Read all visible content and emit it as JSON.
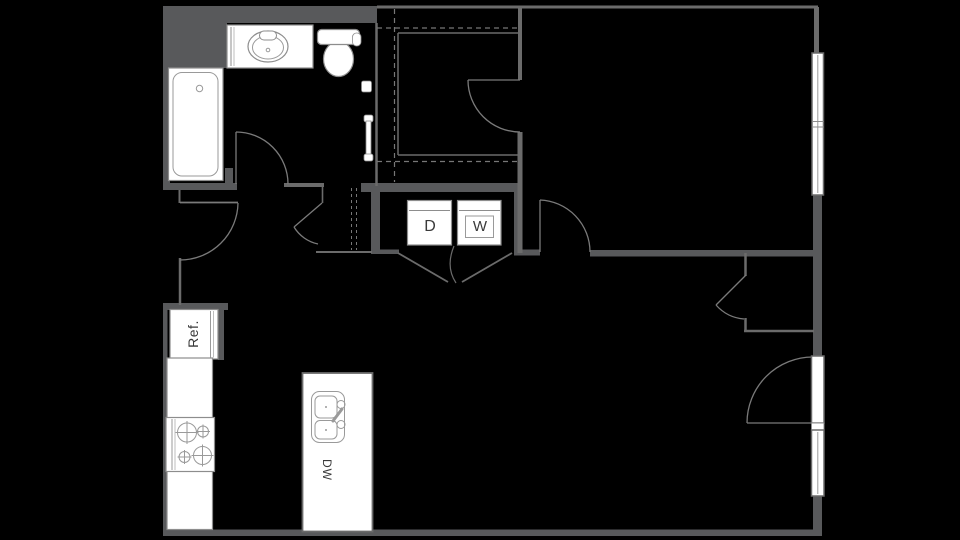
{
  "plan": {
    "type": "apartment-floor-plan",
    "labels": {
      "dryer": "D",
      "washer": "W",
      "refrigerator": "Ref.",
      "dishwasher": "DW"
    },
    "fixtures": [
      "bathtub",
      "vanity-sink",
      "toilet",
      "towel-bar",
      "toilet-paper-holder",
      "walk-in-closet-rod",
      "dryer",
      "washer",
      "bifold-doors",
      "refrigerator",
      "range-burners",
      "kitchen-counter",
      "island-sink",
      "dishwasher",
      "double-hung-window",
      "patio-door",
      "door-swing-arcs"
    ],
    "colors": {
      "background": "#000000",
      "wall_thick": "#58595b",
      "wall_thin": "#6b6b6b",
      "fixture_stroke": "#8d8d8d",
      "arc_stroke": "#7a7a7a",
      "dash_stroke": "#777777",
      "fixture_fill": "#ffffff",
      "label_text": "#3a3a3a"
    }
  }
}
